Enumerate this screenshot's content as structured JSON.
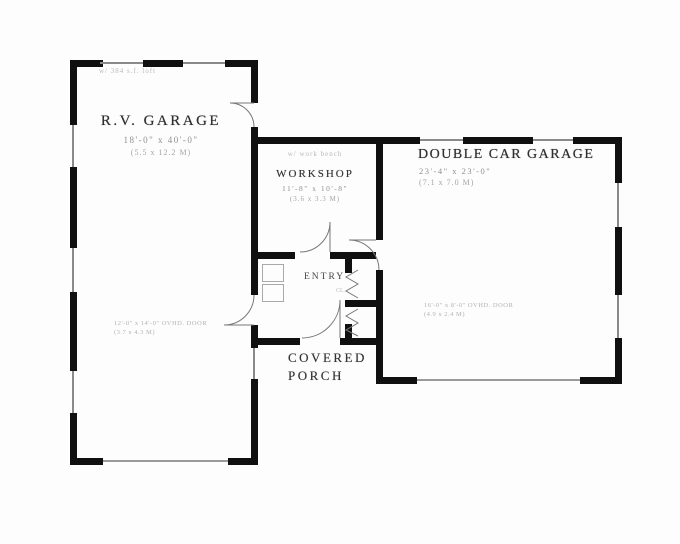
{
  "plan": {
    "labels": {
      "rv_garage": {
        "note": "w/ 384 s.f. loft",
        "name": "R.V. GARAGE",
        "dims": "18'-0\" x 40'-0\"",
        "metric": "(5.5 x 12.2 M)"
      },
      "workshop": {
        "note": "w/ work bench",
        "name": "WORKSHOP",
        "dims": "11'-8\" x 10'-8\"",
        "metric": "(3.6 x 3.3 M)"
      },
      "double_garage": {
        "name": "DOUBLE CAR GARAGE",
        "dims": "23'-4\" x 23'-0\"",
        "metric": "(7.1 x 7.0 M)"
      },
      "entry": {
        "name": "ENTRY"
      },
      "closet": {
        "name": "CL."
      },
      "porch": {
        "line1": "COVERED",
        "line2": "PORCH"
      },
      "rv_door": {
        "line1": "12'-0\" x 14'-0\" OVHD. DOOR",
        "line2": "(3.7 x 4.3 M)"
      },
      "garage_door": {
        "line1": "16'-0\" x 8'-0\" OVHD. DOOR",
        "line2": "(4.9 x 2.4 M)"
      }
    },
    "colors": {
      "wall": "#101010",
      "window_line": "#8a8a8a",
      "door_line": "#9a9a9a",
      "arc_line": "#777777",
      "text_dark": "#2e2e2e",
      "text_mid": "#8f8f8f",
      "text_faint": "#b2b2b2",
      "background": "#fdfdfd"
    }
  }
}
